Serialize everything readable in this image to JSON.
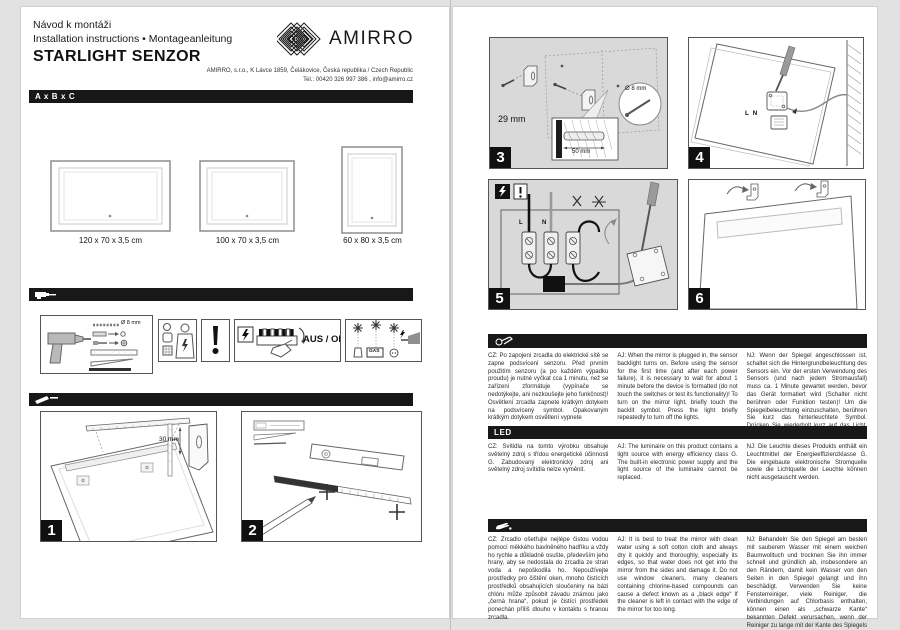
{
  "header": {
    "line1": "Návod k montáži",
    "line2": "Installation instructions • Montageanleitung",
    "title": "STARLIGHT SENZOR",
    "brand": "AMIRRO",
    "address_line1": "AMIRRO, s.r.o., K Lávce 1859, Čelákovice, Česká republika / Czech Republic",
    "address_line2": "Tel.: 00420 326 997 386 , info@amirro.cz"
  },
  "sizes": {
    "bar_label": "A x B x C",
    "items": [
      "120 x 70 x 3,5 cm",
      "100 x 70 x 3,5 cm",
      "60 x 80 x 3,5 cm"
    ]
  },
  "tools": {
    "drill_bit": "Ø 8 mm",
    "aus_off": "AUS / OFF",
    "gas": "GAS"
  },
  "steps": {
    "s1": {
      "num": "1",
      "dim": "30 mm"
    },
    "s2": {
      "num": "2"
    },
    "s3": {
      "num": "3",
      "spacing": "29 mm",
      "depth": "50 mm",
      "diameter": "Ø 8 mm"
    },
    "s4": {
      "num": "4",
      "terminals": "L N"
    },
    "s5": {
      "num": "5",
      "live": "L",
      "neutral": "N"
    },
    "s6": {
      "num": "6"
    }
  },
  "sections": {
    "sensor": {
      "cz": "CZ: Po zapojení zrcadla do elektrické sítě se zapne podsvícení senzoru. Před prvním použitím senzoru (a po každém výpadku proudu) je nutné vyčkat cca 1 minutu, než se zařízení zformátuje (vypínače se nedotýkejte, ani nezkoušejte jeho funkčnost)! Osvětlení zrcadla zapnete krátkým dotykem na podsvícený symbol. Opakovaným krátkým dotykem osvětlení vypnete",
      "aj": "AJ: When the mirror is plugged in, the sensor backlight turns on. Before using the sensor for the first time (and after each power failure), it is necessary to wait for about 1 minute before the device is formatted (do not touch the switches or test its functionality)! To turn on the mirror light, briefly touch the backlit symbol. Press the light briefly repeatedly to turn off the lights.",
      "nj": "NJ: Wenn der Spiegel angeschlossen ist, schaltet sich die Hintergrundbeleuchtung des Sensors ein. Vor der ersten Verwendung des Sensors (und nach jedem Stromausfall) muss ca. 1 Minute gewartet werden, bevor das Gerät formatiert wird (Schalter nicht berühren oder Funktion testen)! Um die Spiegelbeleuchtung einzuschalten, berühren Sie kurz das hinterleuchtete Symbol. Drücken Sie wiederholt kurz auf das Licht, um das Licht auszuschalten."
    },
    "led": {
      "label": "LED",
      "cz": "CZ: Svítidla na tomto výrobku obsahuje světelný zdroj s třídou energetické účinnosti G. Zabudovaný elektronický zdroj ani světelný zdroj svítidla nelze vyměnit.",
      "aj": "AJ: The luminaire on this product contains a light source with energy efficiency class G. The built-in electronic power supply and the light source of the luminaire cannot be replaced.",
      "nj": "NJ: Die Leuchte dieses Produkts enthält ein Leuchtmittel der Energieeffizienzklasse G. Die eingebaute elektronische Stromquelle sowie die Lichtquelle der Leuchte können nicht ausgetauscht werden."
    },
    "care": {
      "cz": "CZ: Zrcadlo ošetřujte nejlépe čistou vodou pomocí měkkého bavlněného hadříku a vždy ho rychle a důkladně osušte, především jeho hrany, aby se nedostala do zrcadla ze stran voda a nepoškodila ho. Nepoužívejte prostředky pro čištění oken, mnoho čistících prostředků obsahujících sloučeniny na bázi chlóru může způsobit závadu známou jako „černá hrana“, pokud je čistící prostředek ponechán příliš dlouho v kontaktu s hranou zrcadla.",
      "aj": "AJ: It is best to treat the mirror with clean water using a soft cotton cloth and always dry it quickly and thoroughly, especially its edges, so that water does not get into the mirror from the sides and damage it. Do not use window cleaners, many cleaners containing chlorine-based compounds can cause a defect known as a „black edge“ If the cleaner is left in contact with the edge of the mirror for too long.",
      "nj": "NJ: Behandeln Sie den Spiegel am besten mit sauberem Wasser mit einem weichen Baumwolltuch und trocknen Sie ihn immer schnell und gründlich ab, insbesondere an den Rändern, damit kein Wasser von den Seiten in den Spiegel gelangt und ihn beschädigt. Verwenden Sie keine Fensterreiniger, viele Reiniger, die Verbindungen auf Chlorbasis enthalten, können einen als „schwarze Kante“ bekannten Defekt verursachen, wenn der Reiniger zu lange mit der Kante des Spiegels in Kontakt bleibt."
    }
  }
}
